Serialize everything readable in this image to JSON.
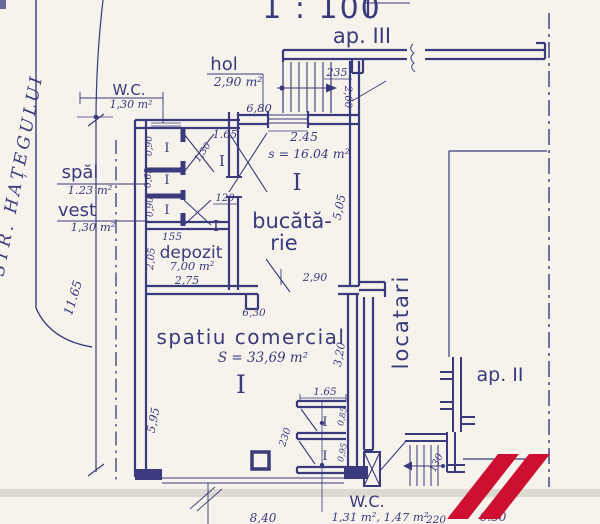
{
  "meta": {
    "scale": "1 : 100",
    "street": "STR. HAȚEGULUI",
    "room_mark": "I"
  },
  "colors": {
    "paper": "#f5f3ec",
    "ink": "#3a3a7c",
    "logo": "#cd1031",
    "band": "#d9d6ce"
  },
  "apartments": {
    "ap3": "ap. III",
    "ap2": "ap. II",
    "locatari": "locatari"
  },
  "rooms": {
    "wc_top": {
      "label": "W.C.",
      "area": "1,30 m²"
    },
    "hol": {
      "label": "hol",
      "area": "2,90 m²"
    },
    "spal": {
      "label": "spăl",
      "area": "1.23 m²"
    },
    "vest": {
      "label": "vest",
      "area": "1,30 m²"
    },
    "depozit": {
      "label": "depozit",
      "area": "7,00 m²"
    },
    "bucatarie": {
      "label_line1": "bucătă-",
      "label_line2": "rie",
      "area": "s = 16.04 m²"
    },
    "spatiu_comercial": {
      "label": "spatiu comercial",
      "area": "S = 33,69 m²"
    },
    "wc_bottom": {
      "label": "W.C.",
      "area": "1,31 m², 1,47 m²"
    }
  },
  "dims": {
    "w235": "235",
    "h200": "2,00",
    "w680": "6,80",
    "w245": "2.45",
    "hol165": "1.65",
    "diag130": "1,30",
    "cell090a": "0,90",
    "cell065": "0,65",
    "cell090b": "0,90",
    "door120": "120",
    "dep155": "155",
    "dep205": "2,05",
    "dep275": "2,75",
    "kit505": "5,05",
    "kit290": "2,90",
    "com630": "6,30",
    "left1165": "11.65",
    "com595": "5,95",
    "com320": "3,20",
    "wc165": "1.65",
    "wc230": "230",
    "wc085": "0,85",
    "wc095": "0,95",
    "st130": "130",
    "bot840": "8,40",
    "bot220": "220",
    "bot650": "6.50"
  }
}
